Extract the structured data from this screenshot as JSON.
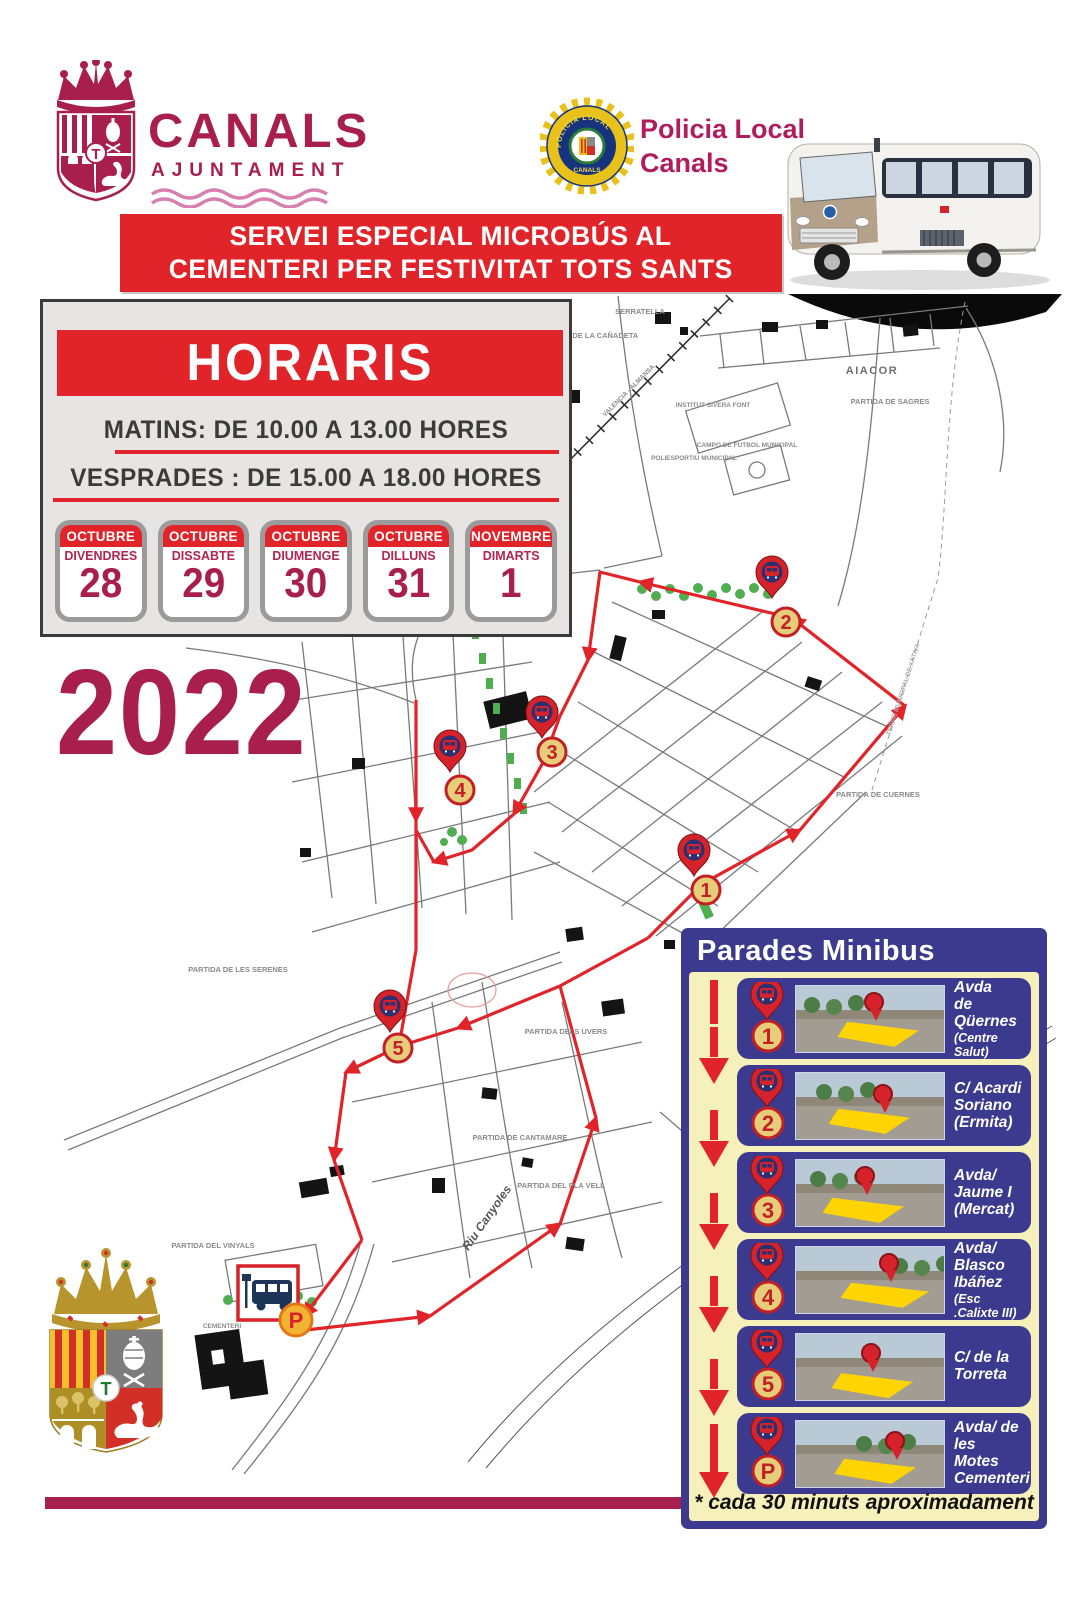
{
  "poster": {
    "year": "2022",
    "logo": {
      "title": "CANALS",
      "subtitle": "AJUNTAMENT"
    },
    "crest": {
      "center_letter": "T"
    },
    "police": {
      "name_line1": "Policia Local",
      "name_line2": "Canals",
      "badge_arc": "POLICIA LOCAL",
      "badge_bottom": "CANALS"
    },
    "banner": {
      "line1": "SERVEI ESPECIAL MICROBÚS AL",
      "line2": "CEMENTERI PER FESTIVITAT TOTS SANTS"
    }
  },
  "horaris": {
    "title": "HORARIS",
    "matins": "MATINS: DE 10.00 A 13.00 HORES",
    "vesprades": "VESPRADES : DE 15.00 A 18.00 HORES",
    "days": [
      {
        "month": "OCTUBRE",
        "weekday": "DIVENDRES",
        "day": "28"
      },
      {
        "month": "OCTUBRE",
        "weekday": "DISSABTE",
        "day": "29"
      },
      {
        "month": "OCTUBRE",
        "weekday": "DIUMENGE",
        "day": "30"
      },
      {
        "month": "OCTUBRE",
        "weekday": "DILLUNS",
        "day": "31"
      },
      {
        "month": "NOVEMBRE",
        "weekday": "DIMARTS",
        "day": "1"
      }
    ]
  },
  "map": {
    "stops": [
      {
        "label": "1"
      },
      {
        "label": "2"
      },
      {
        "label": "3"
      },
      {
        "label": "4"
      },
      {
        "label": "5"
      },
      {
        "label": "P"
      }
    ],
    "labels": [
      {
        "text": "SERRATELLA"
      },
      {
        "text": "PARTIDA DE LA CAÑADETA"
      },
      {
        "text": "AIACOR"
      },
      {
        "text": "PARTIDA DE SAGRES"
      },
      {
        "text": "INSTITUT SIVERA FONT"
      },
      {
        "text": "CAMPO DE FUTBOL MUNICIPAL"
      },
      {
        "text": "POLIESPORTIU MUNICIPAL"
      },
      {
        "text": "VALENCIA - ALMANSA"
      },
      {
        "text": "PARTIDA DE CUERNES"
      },
      {
        "text": "TERME MUNICIPAL DE XÀTIVA"
      },
      {
        "text": "PARTIDA DE LES SERENES"
      },
      {
        "text": "PARTIDA DELS UVERS"
      },
      {
        "text": "PARTIDA DE CANTAMARE"
      },
      {
        "text": "PARTIDA DEL PLA VELL"
      },
      {
        "text": "Riu Canyoles"
      },
      {
        "text": "PARTIDA DEL VINYALS"
      },
      {
        "text": "CEMENTERI"
      }
    ]
  },
  "parades": {
    "title": "Parades Minibus",
    "footnote": "* cada 30 minuts aproximadament",
    "stops": [
      {
        "num": "1",
        "name": "Avda\nde\nQüernes",
        "small": "(Centre Salut)"
      },
      {
        "num": "2",
        "name": "C/ Acardi\nSoriano\n(Ermita)",
        "small": ""
      },
      {
        "num": "3",
        "name": "Avda/\nJaume I\n(Mercat)",
        "small": ""
      },
      {
        "num": "4",
        "name": "Avda/\nBlasco\nIbáñez",
        "small": "(Esc .Calixte III)"
      },
      {
        "num": "5",
        "name": "C/ de la\nTorreta",
        "small": ""
      },
      {
        "num": "P",
        "name": "Avda/ de les\nMotes\nCementeri",
        "small": ""
      }
    ]
  },
  "colors": {
    "crimson": "#a81e4d",
    "red": "#e1232a",
    "navy": "#3c3a8e",
    "cream": "#f6f1bb",
    "pin_red": "#d6222a",
    "circle_yellow": "#e5cd79"
  }
}
